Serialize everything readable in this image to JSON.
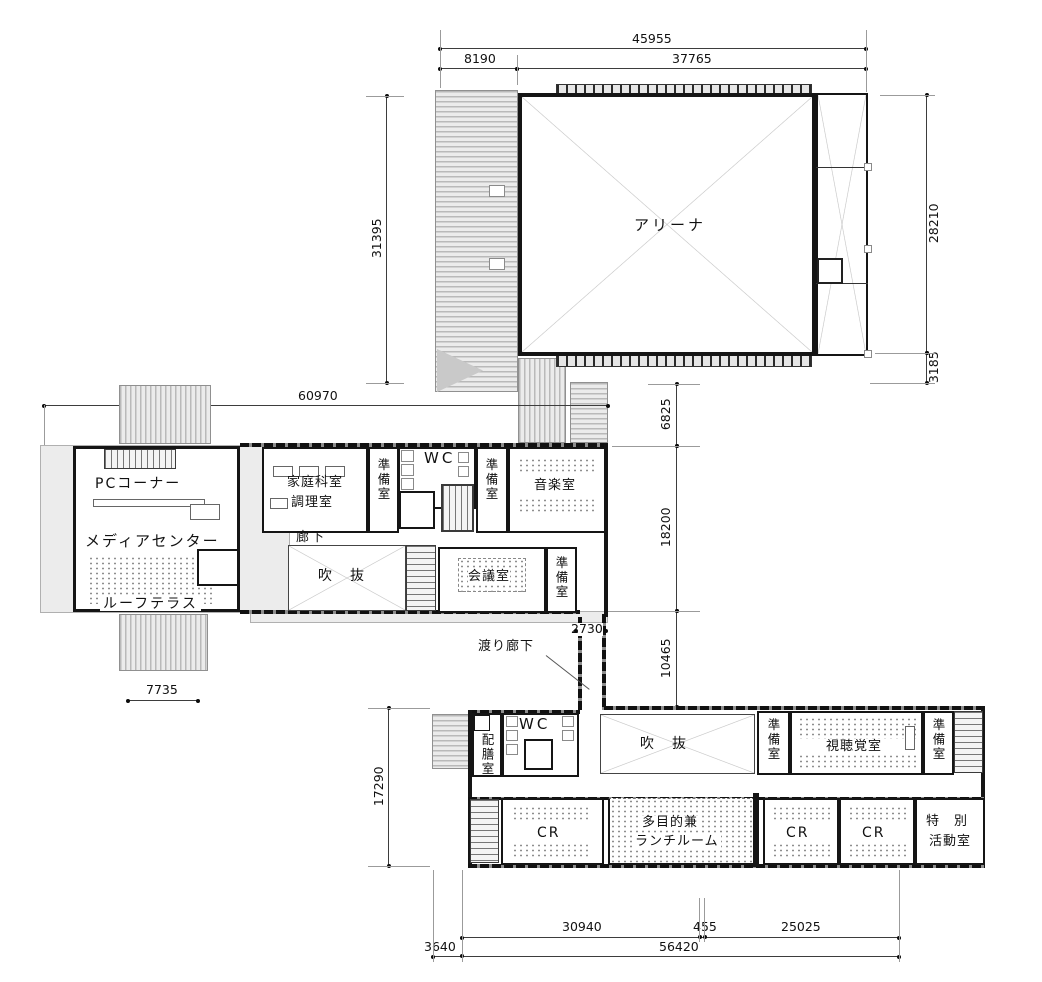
{
  "drawing": {
    "type": "architectural-floor-plan",
    "rooms": {
      "arena": "アリーナ",
      "pc_corner": "PCコーナー",
      "media_center": "メディアセンター",
      "roof_terrace": "ルーフテラス",
      "home_ec_line1": "家庭科室",
      "home_ec_line2": "調理室",
      "prep_room": "準備室",
      "wc": "WC",
      "music_room": "音楽室",
      "corridor": "廊下",
      "void_space": "吹　抜",
      "meeting_room": "会議室",
      "connecting_corridor": "渡り廊下",
      "serving_room": "配膳室",
      "av_room": "視聴覚室",
      "classroom": "CR",
      "multipurpose_line1": "多目的兼",
      "multipurpose_line2": "ランチルーム",
      "special_activity_line1": "特　別",
      "special_activity_line2": "活動室"
    },
    "dimensions": {
      "top_total": "45955",
      "top_seg1": "8190",
      "top_seg2": "37765",
      "arena_left_height": "31395",
      "arena_right_height": "28210",
      "arena_right_small": "3185",
      "mid_width": "60970",
      "gap_arena_wing": "6825",
      "wing_height": "18200",
      "gap_wing_lower": "10465",
      "corridor_width": "2730",
      "canopy_width": "7735",
      "lower_left_height": "17290",
      "bottom_seg1": "30940",
      "bottom_seg2": "455",
      "bottom_seg3": "25025",
      "bottom_offset": "3640",
      "bottom_total": "56420"
    }
  }
}
